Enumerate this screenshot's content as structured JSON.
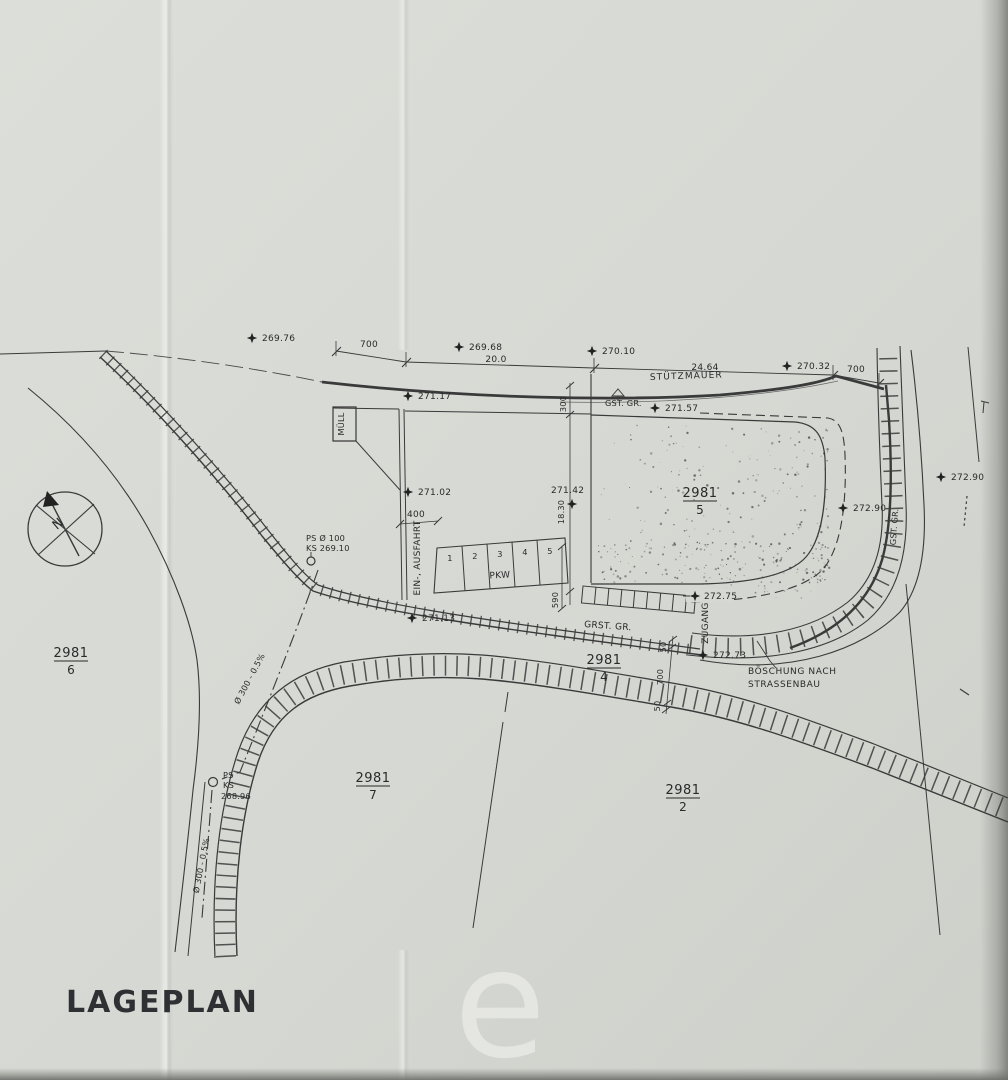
{
  "document": {
    "title": "LAGEPLAN",
    "watermark": "e",
    "north_label": "N"
  },
  "annotations": {
    "stuetzmauer": "STÜTZMAUER",
    "gst_gr_top": "GST. GR.",
    "gst_gr_right": "GST. GR.",
    "grst_gr": "GRST. GR.",
    "muell": "MÜLL",
    "ein_ausfahrt": "EIN-, AUSFAHRT",
    "pkw": "PKW",
    "zugang": "ZUGANG",
    "boeschung_1": "BÖSCHUNG NACH",
    "boeschung_2": "STRASSENBAU"
  },
  "elevations": [
    {
      "value": "269.76"
    },
    {
      "value": "269.68"
    },
    {
      "value": "270.10"
    },
    {
      "value": "270.32"
    },
    {
      "value": "271.17"
    },
    {
      "value": "271.57"
    },
    {
      "value": "271.02"
    },
    {
      "value": "271.42"
    },
    {
      "value": "272.90"
    },
    {
      "value": "272.90"
    },
    {
      "value": "272.75"
    },
    {
      "value": "272.73"
    },
    {
      "value": "271.13"
    }
  ],
  "dimensions": {
    "top_left": "700",
    "top_span": "20.0",
    "top_right_span": "24.64",
    "top_right": "700",
    "wall_offset": "300",
    "parcel5_depth": "18.30",
    "driveway_width": "400",
    "stall_depth": "590",
    "gap_top": "50",
    "road_offset": "700",
    "gap_bottom": "50"
  },
  "parcels": [
    {
      "number": "2981",
      "sub": "5"
    },
    {
      "number": "2981",
      "sub": "4"
    },
    {
      "number": "2981",
      "sub": "6"
    },
    {
      "number": "2981",
      "sub": "7"
    },
    {
      "number": "2981",
      "sub": "2"
    }
  ],
  "stalls": [
    "1",
    "2",
    "3",
    "4",
    "5"
  ],
  "survey_points": {
    "ps1_line1": "PS Ø 100",
    "ps1_line2": "KS 269.10",
    "ps2_line1": "PS",
    "ps2_line2": "KS",
    "ps2_line3": "268.96"
  },
  "pipes": {
    "upper": "Ø 300 - 0.5%",
    "lower": "Ø 300 - 0.5%"
  }
}
